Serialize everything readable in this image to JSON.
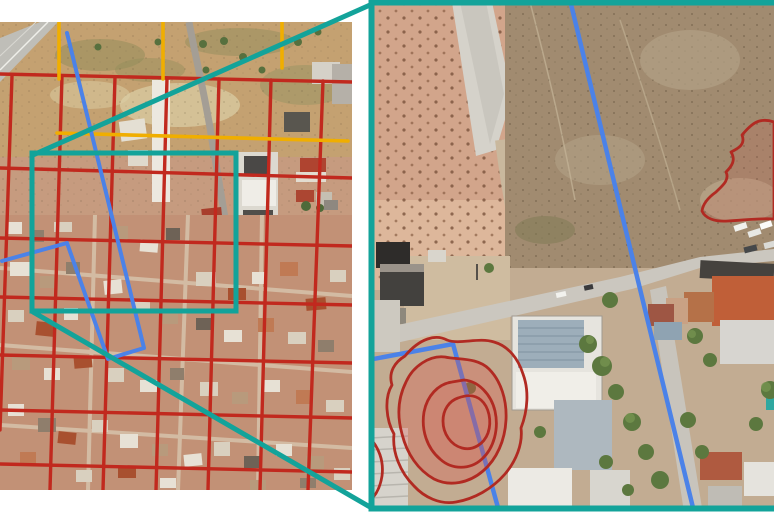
{
  "figure": {
    "kind": "aerial-imagery-annotation-figure",
    "description": "Two-panel satellite image: left overview with survey grid and a teal highlight box, right magnified detail panel with parcel lines and red damage outlines",
    "visible_text": ""
  },
  "colors": {
    "teal": "#13A39A",
    "grid_red": "#C1291E",
    "survey_yellow": "#F0AE00",
    "parcel_blue": "#4B82E8",
    "damage_red": "#B12A22",
    "damage_fill": "rgba(222,80,68,0.30)",
    "damage_fill_light": "rgba(222,80,68,0.14)",
    "background": "#FFFFFF"
  },
  "left_panel": {
    "name": "overview-aerial-image",
    "red_grid": {
      "vertical_lines": [
        {
          "points": "12,76 0,430"
        },
        {
          "points": "62,76 50,490"
        },
        {
          "points": "115,77 103,490"
        },
        {
          "points": "167,78 156,490"
        },
        {
          "points": "219,79 208,490"
        },
        {
          "points": "271,80 260,490"
        },
        {
          "points": "323,81 308,490"
        }
      ],
      "horizontal_lines": [
        {
          "points": "0,74 352,82"
        },
        {
          "points": "0,168 352,178"
        },
        {
          "points": "0,238 352,246"
        },
        {
          "points": "0,297 352,305"
        },
        {
          "points": "0,355 352,363"
        },
        {
          "points": "0,410 352,418"
        },
        {
          "points": "0,464 352,472"
        }
      ]
    },
    "yellow_lines": [
      {
        "points": "59,22 59,79"
      },
      {
        "points": "163,22 163,79"
      },
      {
        "points": "282,22 282,68"
      },
      {
        "points": "57,133 348,141"
      }
    ],
    "blue_outline": {
      "points": "2,261 67,243 108,359 144,348 67,33"
    },
    "highlight_rect": {
      "x": "32",
      "y": "153",
      "width": "204",
      "height": "158"
    }
  },
  "connectors": {
    "top_line": {
      "points": "33,155 370,5"
    },
    "bottom_line": {
      "points": "33,312 370,507"
    }
  },
  "right_panel": {
    "name": "zoom-detail-aerial-image",
    "border": {
      "x": "371.5",
      "y": "2.5",
      "width": "414",
      "height": "506"
    },
    "blue_lines": [
      {
        "points": "570,0 695,516"
      },
      {
        "points": "368,360 453,344"
      },
      {
        "points": "453,344 500,515"
      }
    ],
    "damage_outlines": {
      "outer": {
        "d": "M447,340 C436,334 420,338 405,356 C395,362 388,372 392,385 C384,398 386,420 394,434 C392,452 400,472 414,486 C424,497 440,505 456,502 C474,499 492,489 505,474 C516,461 523,444 521,428 C528,410 529,390 523,374 C518,358 508,346 494,342 C478,337 460,345 447,340 Z"
      },
      "mid": {
        "d": "M445,357 C430,355 413,366 406,382 C398,398 397,416 402,434 C407,454 418,470 434,479 C450,487 469,483 483,471 C497,459 505,440 506,420 C507,400 501,381 489,369 C477,357 458,360 445,357 Z"
      },
      "inner": {
        "d": "M452,382 C438,384 427,396 424,412 C421,430 427,448 440,459 C452,470 470,470 482,459 C494,448 499,429 495,411 C491,394 478,381 464,380 Z"
      },
      "inner_small": {
        "d": "M458,398 C449,401 443,410 443,421 C443,434 451,445 462,448 C473,451 484,444 488,433 C492,421 489,407 481,400 C474,394 466,395 458,398 Z"
      },
      "left_crescent": {
        "d": "M368,436 C379,447 384,461 382,476 C380,489 374,498 367,503"
      },
      "top_right": {
        "d": "M774,122 C757,116 749,127 742,135 C746,145 737,149 731,152 C736,160 732,166 726,172 C730,180 722,186 716,192 C709,197 703,203 702,211 C705,218 714,222 728,221 C746,220 761,218 774,219 Z"
      }
    }
  }
}
